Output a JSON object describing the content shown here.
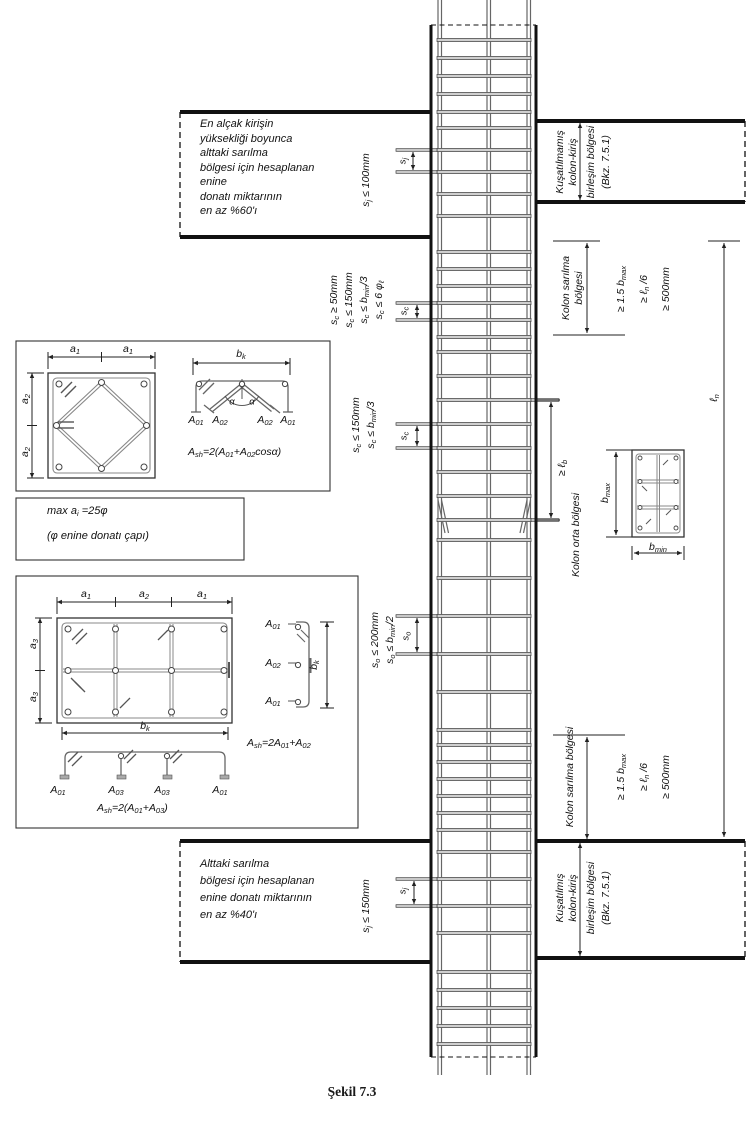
{
  "caption": "Şekil 7.3",
  "notes": {
    "top_left": [
      "En alçak kirişin",
      "yüksekliği boyunca",
      "alttaki sarılma",
      "bölgesi için hesaplanan",
      "enine",
      "donatı miktarının",
      "en az %60'ı"
    ],
    "bottom_left": [
      "Alttaki sarılma",
      "bölgesi için hesaplanan",
      "enine donatı miktarının",
      "en az %40'ı"
    ]
  },
  "labels": {
    "joint_top": [
      "Kuşatılmamış",
      "kolon-kiriş",
      "birleşim bölgesi",
      "(Bkz. 7.5.1)"
    ],
    "joint_bottom": [
      "Kuşatılmış",
      "kolon-kiriş",
      "birleşim bölgesi",
      "(Bkz. 7.5.1)"
    ],
    "kolon_sarilma_2l": [
      "Kolon sarılma",
      "bölgesi"
    ],
    "kolon_sarilma_1l": "Kolon sarılma bölgesi",
    "kolon_orta": "Kolon orta bölgesi",
    "ge_500mm": "≥ 500mm",
    "sj": [
      {
        "t": "s"
      },
      {
        "s": "j"
      }
    ],
    "sc": [
      {
        "t": "s"
      },
      {
        "s": "c"
      }
    ],
    "so": [
      {
        "t": "s"
      },
      {
        "s": "o"
      }
    ],
    "sj_le_100": [
      {
        "t": "s"
      },
      {
        "s": "j"
      },
      {
        "t": " ≤ 100mm"
      }
    ],
    "sj_le_150": [
      {
        "t": "s"
      },
      {
        "s": "j"
      },
      {
        "t": " ≤ 150mm"
      }
    ],
    "sc_ge_50": [
      {
        "t": "s"
      },
      {
        "s": "c"
      },
      {
        "t": " ≥ 50mm"
      }
    ],
    "sc_le_150": [
      {
        "t": "s"
      },
      {
        "s": "c"
      },
      {
        "t": " ≤ 150mm"
      }
    ],
    "sc_le_bmin3": [
      {
        "t": "s"
      },
      {
        "s": "c"
      },
      {
        "t": " ≤ b"
      },
      {
        "s": "min"
      },
      {
        "t": "/3"
      }
    ],
    "sc_le_6phi": [
      {
        "t": "s"
      },
      {
        "s": "c"
      },
      {
        "t": " ≤ 6 φ"
      },
      {
        "s": "ℓ"
      }
    ],
    "so_le_200": [
      {
        "t": "s"
      },
      {
        "s": "o"
      },
      {
        "t": " ≤ 200mm"
      }
    ],
    "so_le_bmin2": [
      {
        "t": "s"
      },
      {
        "s": "o"
      },
      {
        "t": " ≤ b"
      },
      {
        "s": "min"
      },
      {
        "t": "/2"
      }
    ],
    "ge_15bmax": [
      {
        "t": "≥ 1.5 b"
      },
      {
        "s": "max"
      }
    ],
    "ge_ln6": [
      {
        "t": "≥ ℓ"
      },
      {
        "s": "n"
      },
      {
        "t": " /6"
      }
    ],
    "ln": [
      {
        "t": "ℓ"
      },
      {
        "s": "n"
      }
    ],
    "ge_lb": [
      {
        "t": "≥ ℓ"
      },
      {
        "s": "b"
      }
    ],
    "bmax": [
      {
        "t": "b"
      },
      {
        "s": "max"
      }
    ],
    "bmin": [
      {
        "t": "b"
      },
      {
        "s": "min"
      }
    ],
    "bk": [
      {
        "t": "b"
      },
      {
        "s": "k"
      }
    ],
    "a1": [
      {
        "t": "a"
      },
      {
        "s": "1"
      }
    ],
    "a2": [
      {
        "t": "a"
      },
      {
        "s": "2"
      }
    ],
    "a3": [
      {
        "t": "a"
      },
      {
        "s": "3"
      }
    ],
    "A01": [
      {
        "t": "A"
      },
      {
        "s": "01"
      }
    ],
    "A02": [
      {
        "t": "A"
      },
      {
        "s": "02"
      }
    ],
    "A03": [
      {
        "t": "A"
      },
      {
        "s": "03"
      }
    ],
    "alpha": [
      {
        "t": "α"
      }
    ],
    "f_ash1": [
      {
        "t": "A"
      },
      {
        "s": "sh"
      },
      {
        "t": "=2(A"
      },
      {
        "s": "01"
      },
      {
        "t": "+A"
      },
      {
        "s": "02"
      },
      {
        "t": "cosα)"
      }
    ],
    "f_ash2": [
      {
        "t": "A"
      },
      {
        "s": "sh"
      },
      {
        "t": "=2A"
      },
      {
        "s": "01"
      },
      {
        "t": "+A"
      },
      {
        "s": "02"
      }
    ],
    "f_ash3": [
      {
        "t": "A"
      },
      {
        "s": "sh"
      },
      {
        "t": "=2(A"
      },
      {
        "s": "01"
      },
      {
        "t": "+A"
      },
      {
        "s": "03"
      },
      {
        "t": ")"
      }
    ],
    "max_ai": [
      {
        "t": "max a"
      },
      {
        "s": "i"
      },
      {
        "t": " =25φ"
      }
    ],
    "phi_note": [
      {
        "t": "(φ enine donatı çapı)"
      }
    ]
  },
  "column": {
    "tie_zones": [
      {
        "from": 40,
        "to": 112,
        "spacing": 18
      },
      {
        "from": 128,
        "to": 216,
        "spacing": 22
      },
      {
        "from": 252,
        "to": 337,
        "spacing": 17
      },
      {
        "from": 352,
        "to": 520,
        "spacing": 24
      },
      {
        "from": 540,
        "to": 730,
        "spacing": 38
      },
      {
        "from": 745,
        "to": 830,
        "spacing": 17
      },
      {
        "from": 852,
        "to": 933,
        "spacing": 27
      },
      {
        "from": 972,
        "to": 1044,
        "spacing": 18
      }
    ],
    "marker_ties_left": [
      150,
      172,
      303,
      320,
      424,
      448,
      616,
      654,
      879,
      906
    ],
    "marker_ties_right": [
      400,
      520
    ]
  },
  "colors": {
    "line": "#1a1a1a",
    "tie_fill": "#cfcfcf",
    "tie_edge": "#3c3c3c",
    "rebar": "#666"
  }
}
